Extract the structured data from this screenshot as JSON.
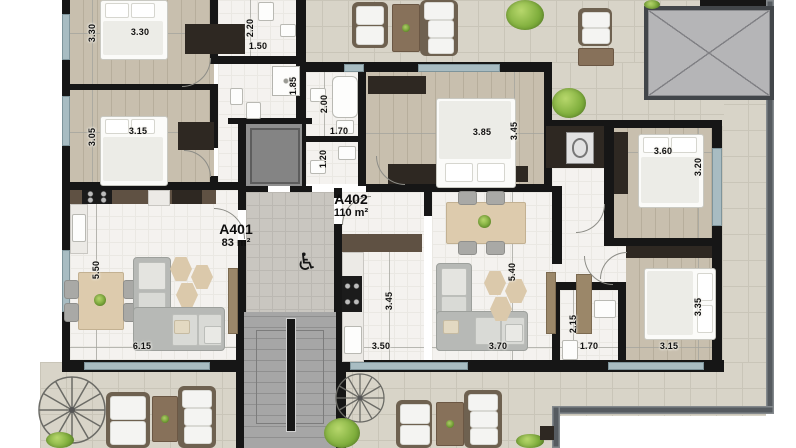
{
  "units": {
    "a401": {
      "id": "A401",
      "area": "83 m²"
    },
    "a402": {
      "id": "A402",
      "area": "110 m²"
    }
  },
  "icons": {
    "accessible": "♿"
  },
  "dims": {
    "a401_bed1_h": "3.30",
    "a401_bed1_w": "3.30",
    "a401_bath1_h": "2.20",
    "a401_bath1_w": "1.50",
    "a401_bed2_h": "3.05",
    "a401_bed2_w": "3.15",
    "a401_bath2_h": "1.85",
    "a402_bath1_h": "2.00",
    "a402_bath1_w": "1.70",
    "a402_wc_h": "1.20",
    "a402_bed1_w": "3.85",
    "a402_bed1_h": "3.45",
    "a402_bed2_w": "3.60",
    "a402_bed2_h": "3.20",
    "a401_living_h": "5.50",
    "a401_living_w": "6.15",
    "a402_kitchen_h": "3.45",
    "a402_kitchen_w": "3.50",
    "a402_living_w": "3.70",
    "a402_living_h": "5.40",
    "a402_bath2_h": "2.15",
    "a402_bath2_w": "1.70",
    "a402_bed3_h": "3.35",
    "a402_bed3_w": "3.15"
  },
  "palette": {
    "wall": "#161616",
    "wood_floor": "#c8bfae",
    "terrace_tile": "#d8d4c8",
    "window": "#a8bcc2",
    "interior": "#f4f2ef",
    "core_gray": "#9f9f9f",
    "plant_green": "#7fae3c",
    "kitchen_cabinet": "#5f5143",
    "sofa_gray": "#b7b9b6",
    "table_beige": "#ddcbad",
    "rattan": "#6e6150"
  }
}
